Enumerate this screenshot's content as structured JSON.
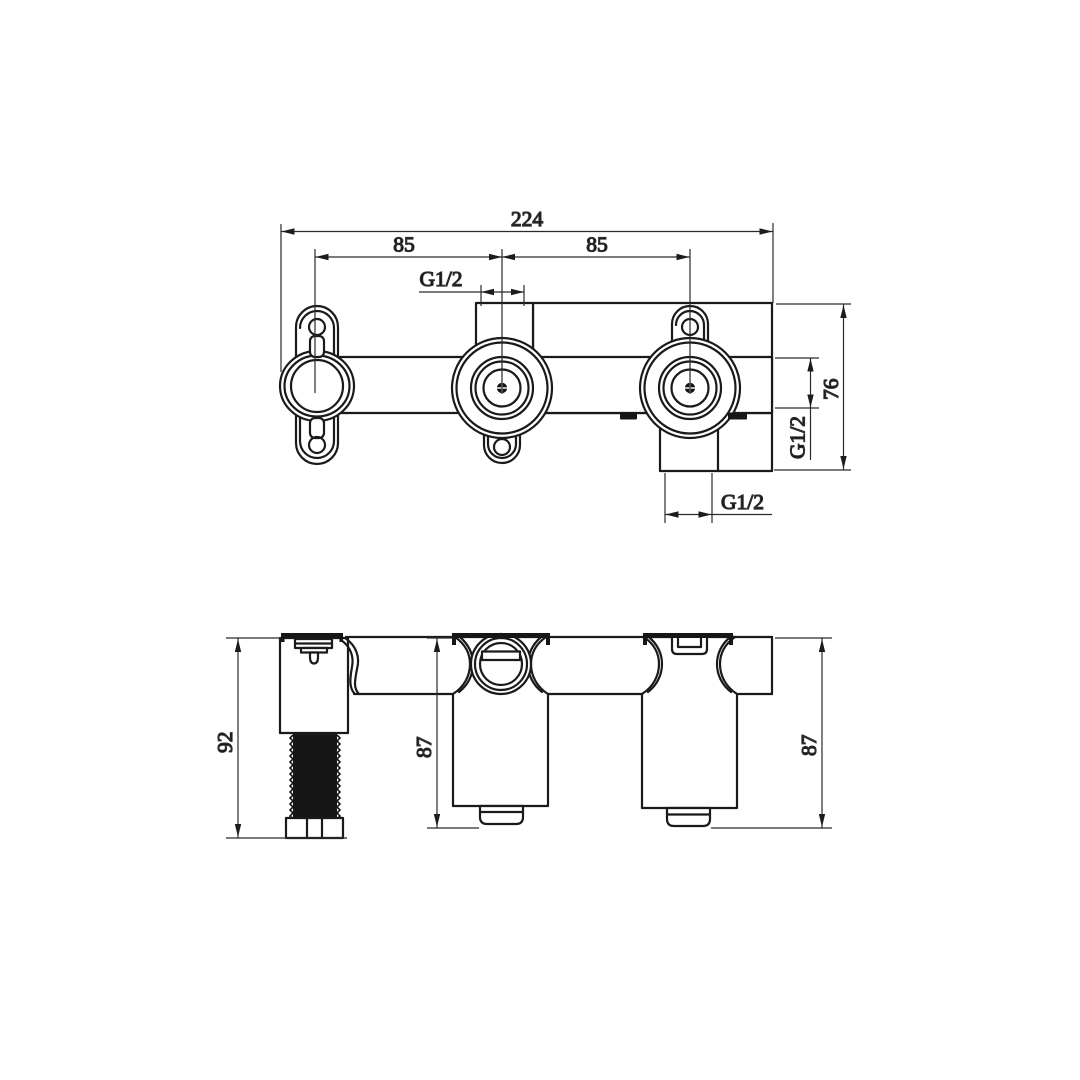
{
  "page": {
    "background": "#ffffff"
  },
  "drawing": {
    "line_color": "#1a1a1a",
    "dim_color": "#2a2a2a",
    "top_view": {
      "overall_width": "224",
      "spacing_left": "85",
      "spacing_right": "85",
      "center_port": "G1/2",
      "side_port": "G1/2",
      "bottom_port": "G1/2",
      "depth": "76"
    },
    "front_view": {
      "left_height": "92",
      "middle_height": "87",
      "right_height": "87"
    }
  }
}
